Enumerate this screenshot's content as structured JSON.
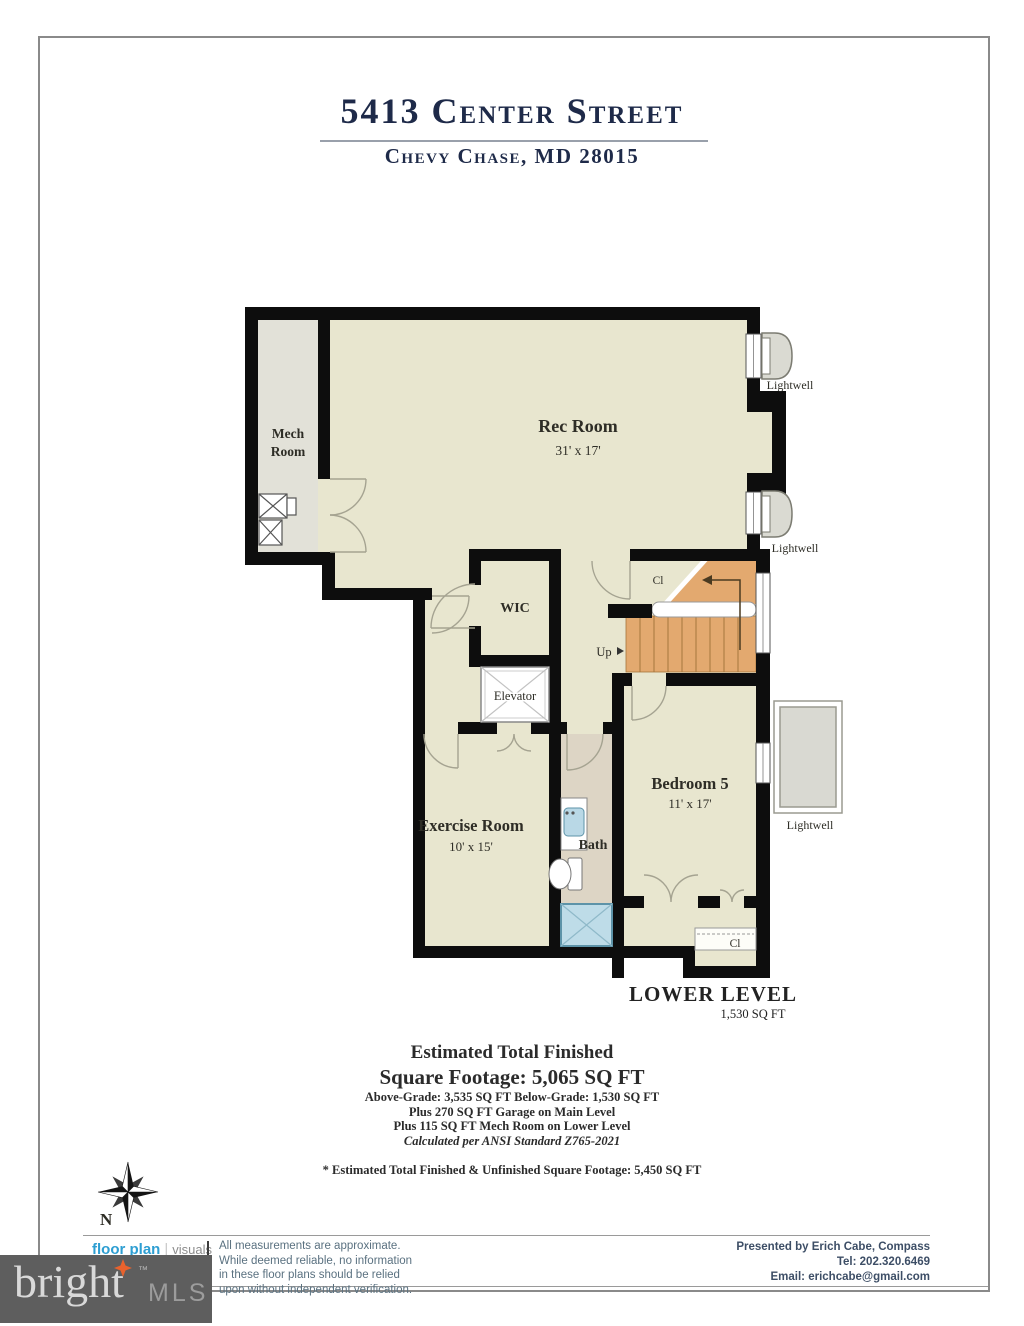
{
  "title": {
    "address": "5413 Center Street",
    "city_line": "Chevy Chase, MD 28015"
  },
  "plan": {
    "rooms": {
      "mech": {
        "line1": "Mech",
        "line2": "Room"
      },
      "rec": {
        "name": "Rec Room",
        "dims": "31' x 17'"
      },
      "wic": {
        "name": "WIC"
      },
      "elevator": {
        "name": "Elevator"
      },
      "exercise": {
        "name": "Exercise Room",
        "dims": "10' x 15'"
      },
      "bath": {
        "name": "Bath"
      },
      "bedroom": {
        "name": "Bedroom 5",
        "dims": "11' x 17'"
      },
      "closet_stair": {
        "label": "Cl"
      },
      "closet_bedroom": {
        "label": "Cl"
      },
      "up_label": "Up"
    },
    "lightwells": [
      "Lightwell",
      "Lightwell",
      "Lightwell"
    ],
    "level": {
      "name": "LOWER LEVEL",
      "sqft": "1,530 SQ FT"
    }
  },
  "compass": {
    "north_label": "N"
  },
  "summary": {
    "line1": "Estimated Total Finished",
    "line2": "Square Footage: 5,065 SQ FT",
    "line3": "Above-Grade: 3,535 SQ FT    Below-Grade: 1,530 SQ FT",
    "line4": "Plus 270 SQ FT Garage on Main Level",
    "line5": "Plus 115 SQ FT Mech Room on Lower Level",
    "line6": "Calculated per ANSI Standard Z765-2021",
    "footnote": "* Estimated Total Finished & Unfinished Square Footage: 5,450 SQ FT"
  },
  "footer": {
    "logo_primary": "floor plan",
    "logo_separator": "|",
    "logo_secondary": "visuals",
    "disclaimer_lines": [
      "All measurements are approximate.",
      "While deemed reliable, no information",
      "in these floor plans should be relied",
      "upon without independent verification."
    ],
    "presented_lines": [
      "Presented by Erich Cabe, Compass",
      "Tel: 202.320.6469",
      "Email: erichcabe@gmail.com"
    ]
  },
  "watermark": {
    "brand": "bright",
    "tm": "™",
    "suffix": "MLS"
  },
  "colors": {
    "wall": "#0d0d0d",
    "floor_cream": "#e8e6cf",
    "floor_mech": "#e2e1d8",
    "floor_bath": "#ddd5c5",
    "stairs_orange": "#e3a96f",
    "shower_blue": "#bedce8",
    "title_navy": "#1e2a49",
    "logo_blue": "#2d9ed2",
    "watermark_gray": "#5e5e5e",
    "watermark_star_orange": "#e8622d"
  }
}
